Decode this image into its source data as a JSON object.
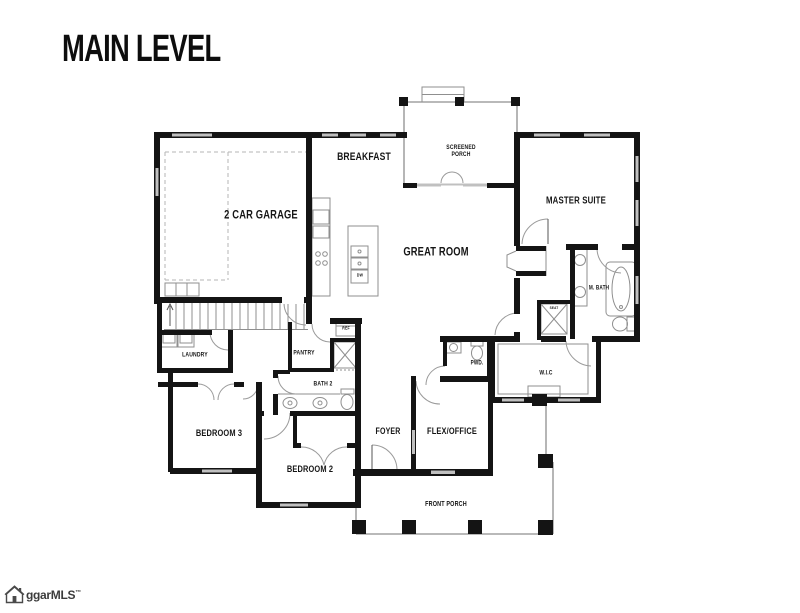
{
  "header": {
    "title": "MAIN LEVEL"
  },
  "floor_plan": {
    "rooms": {
      "garage": "2 CAR GARAGE",
      "breakfast": "BREAKFAST",
      "screened_porch": "SCREENED PORCH",
      "master_suite": "MASTER SUITE",
      "great_room": "GREAT ROOM",
      "master_bath": "M. BATH",
      "laundry": "LAUNDRY",
      "pantry": "PANTRY",
      "bath2": "BATH 2",
      "powder": "PWD.",
      "walk_in_closet": "W.I.C",
      "bedroom3": "BEDROOM 3",
      "bedroom2": "BEDROOM 2",
      "foyer": "FOYER",
      "flex_office": "FLEX/OFFICE",
      "front_porch": "FRONT PORCH"
    },
    "fixtures": {
      "refrigerator": "REF",
      "dishwasher": "DW",
      "shower_seat": "SEAT"
    }
  },
  "branding": {
    "logo_text": "ggarMLS",
    "trademark": "™"
  },
  "colors": {
    "wall": "#141414",
    "thin_line": "#8f8f8f",
    "window": "#c0c0c0",
    "label": "#151515"
  }
}
